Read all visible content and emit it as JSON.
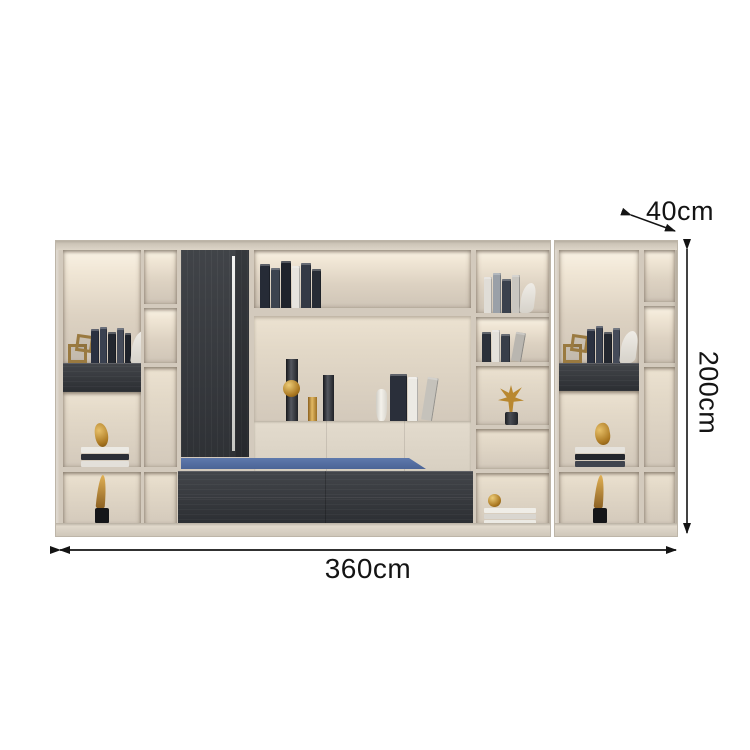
{
  "product": {
    "type": "wall bookcase display cabinet"
  },
  "annotations": {
    "depth": {
      "label": "40cm",
      "orientation": "diagonal-top-right"
    },
    "height": {
      "label": "200cm",
      "orientation": "vertical-right"
    },
    "width": {
      "label": "360cm",
      "orientation": "horizontal-bottom"
    }
  },
  "colors": {
    "background": "#ffffff",
    "frame_cream": "#d7cfc2",
    "interior_lit": "#f7f0e2",
    "interior_shade": "#cfc5b7",
    "dark_wood": "#35383d",
    "accent_blue": "#5571a5",
    "gold_decor": "#b9882f",
    "dimension_line": "#141414"
  }
}
